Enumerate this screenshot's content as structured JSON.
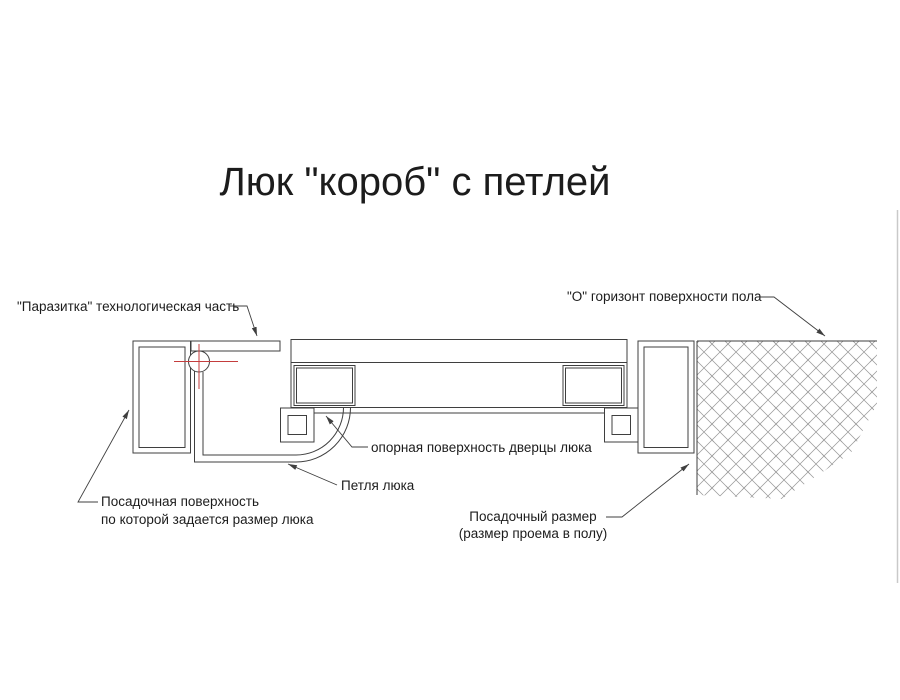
{
  "title": "Люк \"короб\" с петлей",
  "labels": {
    "parasitka": "\"Паразитка\" технологическая часть",
    "horizon": "\"О\" горизонт поверхности пола",
    "support_surface": "опорная поверхность дверцы люка",
    "hinge": "Петля люка",
    "seating_surface_line1": "Посадочная поверхность",
    "seating_surface_line2": "по которой задается размер люка",
    "seating_size_line1": "Посадочный размер",
    "seating_size_line2": "(размер проема в полу)"
  },
  "colors": {
    "bg": "#ffffff",
    "line": "#3f3f3f",
    "hatch": "#989898",
    "block_hatch": "#a6a6a6",
    "red": "#c43d3d",
    "text": "#1c1c1c",
    "stipple": "#cfcfcf",
    "stipple_dot": "#8f8f8f",
    "edge": "#c9c9c9"
  }
}
